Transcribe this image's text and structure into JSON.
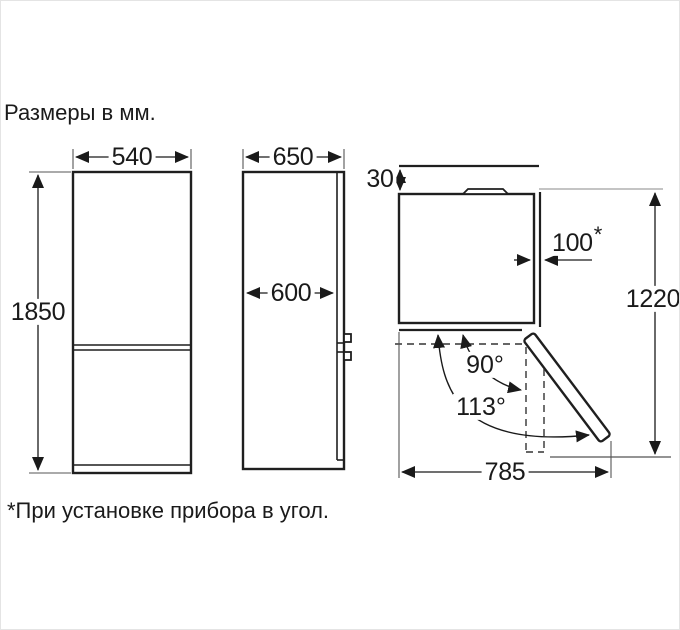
{
  "title": "Размеры в мм.",
  "footnote": "*При установке прибора в угол.",
  "dimensions": {
    "front_width": "540",
    "front_height": "1850",
    "side_depth_total": "650",
    "side_depth_body": "600",
    "top_rear_gap": "30",
    "top_side_gap": "100",
    "top_side_gap_note": "*",
    "top_depth_door_open": "1220",
    "top_width_door_open": "785",
    "door_angle_90": "90°",
    "door_angle_113": "113°"
  }
}
